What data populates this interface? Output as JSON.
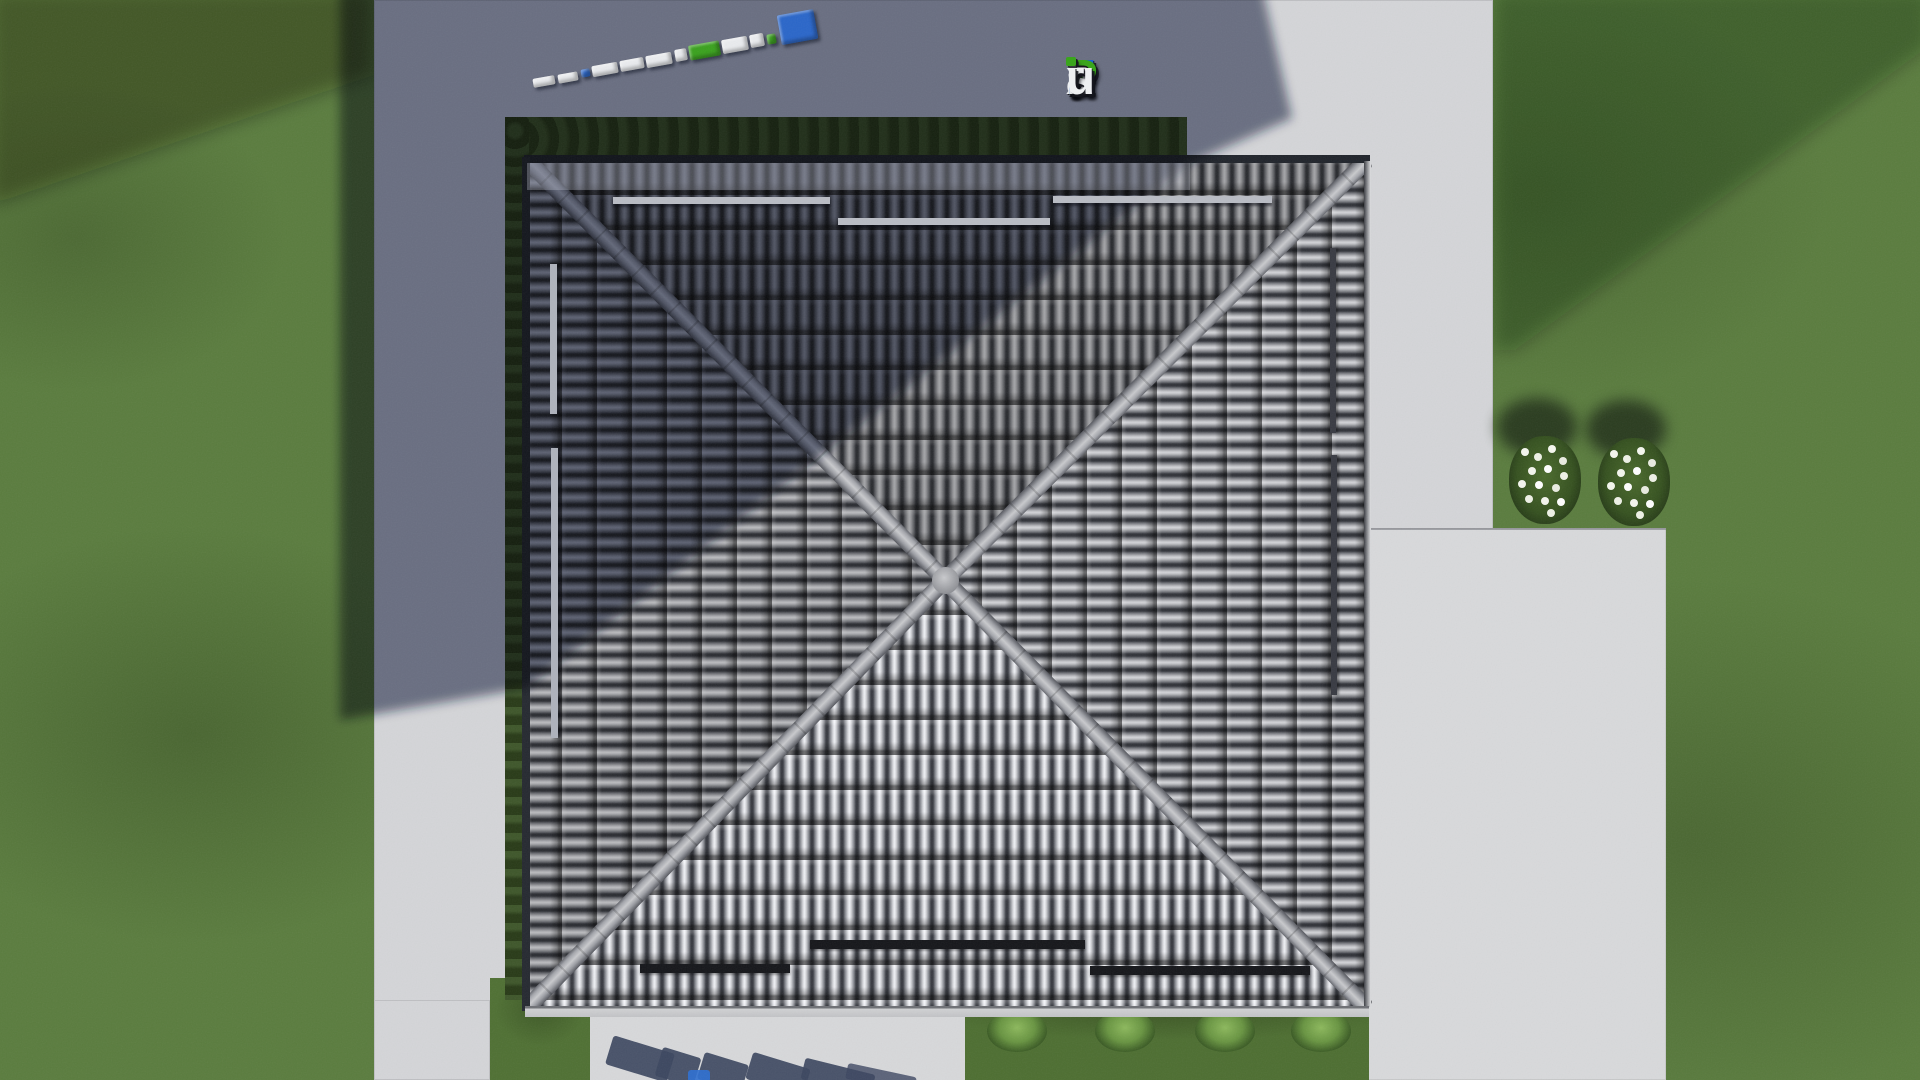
{
  "watermark": {
    "text": "FixPlans.ru",
    "letters": [
      {
        "ch": "F",
        "color": "#1b61d1"
      },
      {
        "ch": "i",
        "color": "#eef0f2"
      },
      {
        "ch": "x",
        "color": "#eef0f2"
      },
      {
        "ch": "P",
        "color": "#3aa51d"
      },
      {
        "ch": "l",
        "color": "#eef0f2"
      },
      {
        "ch": "a",
        "color": "#eef0f2"
      },
      {
        "ch": "n",
        "color": "#eef0f2"
      },
      {
        "ch": "s",
        "color": "#eef0f2"
      },
      {
        "ch": ".",
        "color": "#1b61d1"
      },
      {
        "ch": "r",
        "color": "#eef0f2"
      },
      {
        "ch": "u",
        "color": "#eef0f2"
      }
    ],
    "i_dot_color": "#3aa51d",
    "shadow_color": "#16181e"
  },
  "ground_logo": {
    "description": "3D FixPlans.ru sign lying on the pavement, seen from above",
    "angle_deg": -10.2,
    "segments": [
      {
        "w": 26,
        "h": 9,
        "color": "#e9ebee"
      },
      {
        "w": 24,
        "h": 9,
        "color": "#e9ebee"
      },
      {
        "w": 10,
        "h": 8,
        "color": "#2a66c9"
      },
      {
        "w": 30,
        "h": 11,
        "color": "#e9ebee"
      },
      {
        "w": 28,
        "h": 11,
        "color": "#e9ebee"
      },
      {
        "w": 30,
        "h": 12,
        "color": "#e9ebee"
      },
      {
        "w": 14,
        "h": 12,
        "color": "#e9ebee"
      },
      {
        "w": 36,
        "h": 15,
        "color": "#3aa11e"
      },
      {
        "w": 30,
        "h": 14,
        "color": "#e9ebee"
      },
      {
        "w": 16,
        "h": 13,
        "color": "#e9ebee"
      },
      {
        "w": 11,
        "h": 10,
        "color": "#3aa11e"
      },
      {
        "w": 44,
        "h": 30,
        "color": "#2a66c9"
      }
    ]
  },
  "palette": {
    "grass": "#5a7c3e",
    "grass_dark": "#47642f",
    "concrete": "#d4d5d8",
    "concrete_shadow": "#6c7080",
    "tile_highlight": "#cfd0d4",
    "tile_mid": "#8f9197",
    "tile_groove": "#303238",
    "ridge_cap": "#c9cacd",
    "hedge": "#2a3d18",
    "cast_shadow": "#1a2142",
    "snow_guard_dark": "#15161a",
    "snow_guard_light": "#b9bcc4"
  }
}
